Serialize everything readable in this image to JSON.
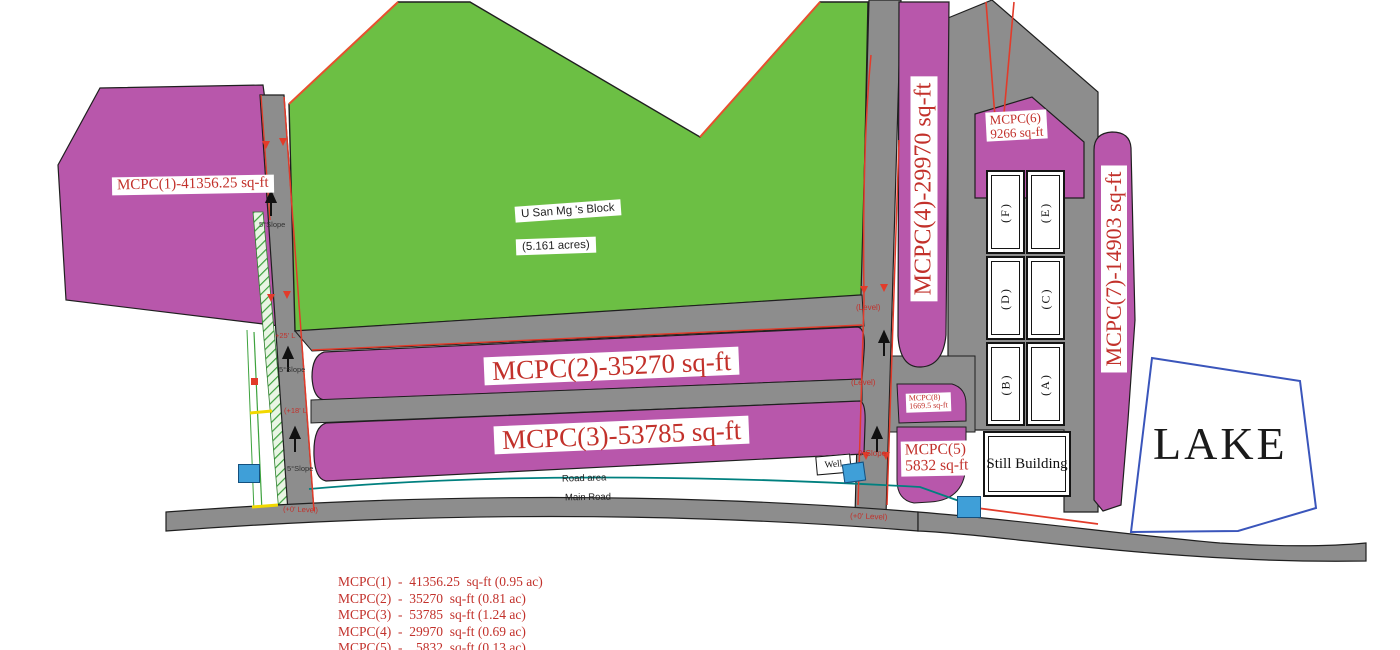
{
  "block": {
    "name": "U San Mg 's Block",
    "area": "(5.161 acres)"
  },
  "plots": {
    "p1": {
      "label": "MCPC(1)-41356.25 sq-ft"
    },
    "p2": {
      "label": "MCPC(2)-35270 sq-ft"
    },
    "p3": {
      "label": "MCPC(3)-53785 sq-ft"
    },
    "p4": {
      "label": "MCPC(4)-29970 sq-ft"
    },
    "p5": {
      "line1": "MCPC(5)",
      "line2": "5832 sq-ft"
    },
    "p6": {
      "line1": "MCPC(6)",
      "line2": "9266 sq-ft"
    },
    "p7": {
      "label": "MCPC(7)-14903 sq-ft"
    },
    "p8": {
      "line1": "MCPC(8)",
      "line2": "1669.5 sq-ft"
    }
  },
  "units": {
    "labels": [
      "(F)",
      "(E)",
      "(D)",
      "(C)",
      "(B)",
      "(A)"
    ]
  },
  "buildings": {
    "still_building": "Still Building",
    "well": "Well"
  },
  "lake": {
    "label": "LAKE"
  },
  "roads": {
    "road_area": "Road area",
    "main_road": "Main Road"
  },
  "annotations": {
    "slope5_1": "5°Slope",
    "level25": "+25' L",
    "slope5_2": "5°Slope",
    "level18": "(+18' L",
    "slope5_3": "5°Slope",
    "level0_left": "(+0' Level)",
    "level_mid_1": "(Level)",
    "level_mid_2": "(Level)",
    "slope0": "0°Slope",
    "level0_mid": "(+0' Level)"
  },
  "legend": {
    "items": [
      "MCPC(1)  -  41356.25  sq-ft (0.95 ac)",
      "MCPC(2)  -  35270  sq-ft (0.81 ac)",
      "MCPC(3)  -  53785  sq-ft (1.24 ac)",
      "MCPC(4)  -  29970  sq-ft (0.69 ac)",
      "MCPC(5)  -    5832  sq-ft (0.13 ac)"
    ]
  },
  "colors": {
    "plot_magenta": "#b857ab",
    "block_green": "#6cbf44",
    "road_gray": "#8d8d8d",
    "red_text": "#c2312b",
    "boundary_red": "#e23b2a",
    "teal_line": "#00807f",
    "lake_border": "#3a55bb",
    "blue_marker": "#3f9fd8",
    "hatch_green": "#3da23d",
    "yellow_mark": "#f2d800"
  }
}
